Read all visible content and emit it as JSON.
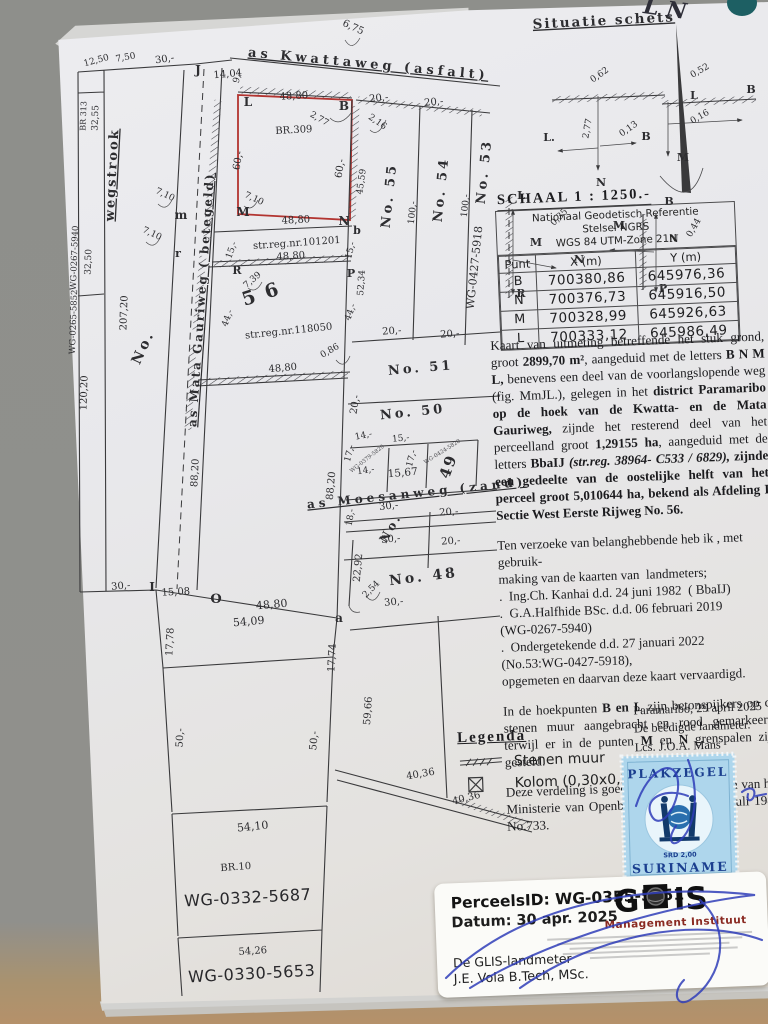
{
  "situatie": {
    "title": "Situatie schets"
  },
  "schaal": "SCHAAL 1 : 1250.-",
  "table": {
    "title_lines": [
      "Nationaal Geodetisch Referentie",
      "Stelsel NGRS",
      "WGS 84 UTM-Zone 21N"
    ],
    "headers": [
      "Punt",
      "X (m)",
      "Y (m)"
    ],
    "rows": [
      [
        "B",
        "700380,86",
        "645976,36"
      ],
      [
        "N",
        "700376,73",
        "645916,50"
      ],
      [
        "M",
        "700328,99",
        "645926,63"
      ],
      [
        "L",
        "700333,12",
        "645986,49"
      ]
    ]
  },
  "paragraphs": [
    {
      "segments": [
        {
          "t": "Kaart van uitmeting betreffende het stuk grond, groot "
        },
        {
          "t": "2899,70 m²",
          "c": "b"
        },
        {
          "t": ", aangeduid met de letters "
        },
        {
          "t": "B N M L,",
          "c": "b"
        },
        {
          "t": " benevens een deel van de voorlangslopende weg (fig. MmJL.), gelegen in het "
        },
        {
          "t": "district Paramaribo op de hoek van de Kwatta- en de Mata Gauriweg,",
          "c": "b"
        },
        {
          "t": " zijnde het resterend deel van het perceelland groot "
        },
        {
          "t": "1,29155 ha",
          "c": "b"
        },
        {
          "t": ", aangeduid met de letters "
        },
        {
          "t": "BbaIJ ",
          "c": "b"
        },
        {
          "t": "(str.reg. 38964- C533 / 6829),",
          "c": "bi"
        },
        {
          "t": " "
        },
        {
          "t": "zijnde een gedeelte van de oostelijke helft van het perceel groot 5,010644 ha, bekend als Afdeling I Sectie West Eerste Rijweg No. 56.",
          "c": "b"
        }
      ]
    },
    {
      "cls": "lines",
      "segments": [
        {
          "t": "Ten verzoeke van belanghebbende heb ik , met gebruik-\nmaking van de kaarten van  landmeters;\n.  Ing.Ch. Kanhai d.d. 24 juni 1982  ( BbaIJ)\n.  G.A.Halfhide BSc. d.d. 06 februari 2019\n(WG-0267-5940)\n.  Ondergetekende d.d. 27 januari 2022\n(No.53:WG-0427-5918),\nopgemeten en daarvan deze kaart vervaardigd."
        }
      ]
    },
    {
      "segments": [
        {
          "t": "In de hoekpunten "
        },
        {
          "t": "B en L",
          "c": "b"
        },
        {
          "t": "  zijn betonspijkers op de stenen muur aangebracht en rood gemarkeerd, terwijl er in de punten "
        },
        {
          "t": "M",
          "c": "b"
        },
        {
          "t": " en "
        },
        {
          "t": "N",
          "c": "b"
        },
        {
          "t": " grenspalen zijn gesteld."
        }
      ]
    },
    {
      "segments": [
        {
          "t": "Deze verdeling is goedgekeurd bij schrijven van het Ministerie van Openbare Werken d.d. 09 juli 1984 No.733."
        }
      ]
    }
  ],
  "signoff": {
    "place_date": "Paramaribo, 29 april 2025",
    "role": "De beëdigde landmeter.",
    "name": "Lcs. J.O.A. Mans"
  },
  "legend": {
    "title": "Legenda",
    "items": [
      {
        "icon": "stenen-muur-symbol",
        "label": "Stenen muur"
      },
      {
        "icon": "kolom-symbol",
        "label": "Kolom (0,30x0,30)"
      }
    ]
  },
  "stamp": {
    "top": "PLAKZEGEL",
    "value": "SRD 2,00",
    "country": "SURINAME"
  },
  "sticker": {
    "perceel": "PerceelsID: WG-0355-5951",
    "datum": "Datum: 30 apr. 2025",
    "landmeter_label": "De GLIS-landmeter",
    "landmeter_name": "J.E. Vola B.Tech, MSc.",
    "logo": "GLIS",
    "logo_sub": "Management Instituut"
  },
  "map": {
    "labels": [
      {
        "t": "12,50",
        "x": 97,
        "y": 63,
        "r": -15,
        "s": 9
      },
      {
        "t": "7,50",
        "x": 126,
        "y": 60,
        "r": -10,
        "s": 9
      },
      {
        "t": "30,-",
        "x": 165,
        "y": 62,
        "r": -8,
        "s": 10
      },
      {
        "t": "J",
        "x": 198,
        "y": 74,
        "s": 12,
        "c": "b"
      },
      {
        "t": "14,04",
        "x": 228,
        "y": 77,
        "r": -5,
        "s": 10
      },
      {
        "t": "9,-",
        "x": 240,
        "y": 78,
        "r": -75,
        "s": 9
      },
      {
        "t": "6,75",
        "x": 352,
        "y": 30,
        "r": 25,
        "s": 10
      },
      {
        "t": "as Kwattaweg (asfalt)",
        "x": 368,
        "y": 68,
        "r": 5.5,
        "s": 13,
        "c": "street"
      },
      {
        "t": "BR 313",
        "x": 86,
        "y": 116,
        "r": -88,
        "s": 8
      },
      {
        "t": "32,55",
        "x": 98,
        "y": 118,
        "r": -88,
        "s": 9
      },
      {
        "t": "wegstrook",
        "x": 116,
        "y": 175,
        "r": -87,
        "s": 13,
        "c": "streetv"
      },
      {
        "t": "WG-0267-5940",
        "x": 77,
        "y": 258,
        "r": -88,
        "s": 8.5
      },
      {
        "t": "32,50",
        "x": 91,
        "y": 262,
        "r": -88,
        "s": 9
      },
      {
        "t": "WG-0265-5852",
        "x": 76,
        "y": 322,
        "r": -88,
        "s": 8.5
      },
      {
        "t": "120,20",
        "x": 87,
        "y": 393,
        "r": -88,
        "s": 10
      },
      {
        "t": "207,20",
        "x": 127,
        "y": 313,
        "r": -88,
        "s": 10
      },
      {
        "t": "No.",
        "x": 147,
        "y": 349,
        "r": -65,
        "s": 14,
        "c": "spread"
      },
      {
        "t": "as Mata Gauriweg ( betegeld)",
        "x": 205,
        "y": 300,
        "r": -86,
        "s": 12,
        "c": "streetv"
      },
      {
        "t": "7,10",
        "x": 164,
        "y": 197,
        "r": 25,
        "s": 9
      },
      {
        "t": "m",
        "x": 181,
        "y": 219,
        "s": 12,
        "c": "b"
      },
      {
        "t": "7,10",
        "x": 151,
        "y": 236,
        "r": 25,
        "s": 9
      },
      {
        "t": "r",
        "x": 178,
        "y": 257,
        "s": 11,
        "c": "b"
      },
      {
        "t": "L",
        "x": 248,
        "y": 106,
        "s": 12,
        "c": "b"
      },
      {
        "t": "48,80",
        "x": 294,
        "y": 99,
        "r": -3,
        "s": 10
      },
      {
        "t": "B",
        "x": 344,
        "y": 110,
        "s": 12,
        "c": "b"
      },
      {
        "t": "2,77",
        "x": 318,
        "y": 121,
        "r": 30,
        "s": 9
      },
      {
        "t": "BR.309",
        "x": 294,
        "y": 133,
        "r": -3,
        "s": 10
      },
      {
        "t": "60,-",
        "x": 241,
        "y": 161,
        "r": -80,
        "s": 10
      },
      {
        "t": "60,-",
        "x": 343,
        "y": 169,
        "r": -80,
        "s": 10
      },
      {
        "t": "7,10",
        "x": 253,
        "y": 201,
        "r": 25,
        "s": 9
      },
      {
        "t": "M",
        "x": 243,
        "y": 216,
        "s": 12,
        "c": "b"
      },
      {
        "t": "48,80",
        "x": 296,
        "y": 223,
        "r": -3,
        "s": 10
      },
      {
        "t": "N",
        "x": 344,
        "y": 225,
        "s": 12,
        "c": "b"
      },
      {
        "t": "20,-",
        "x": 379,
        "y": 101,
        "r": -5,
        "s": 10
      },
      {
        "t": "2,16",
        "x": 376,
        "y": 124,
        "r": 35,
        "s": 9
      },
      {
        "t": "45,59",
        "x": 364,
        "y": 182,
        "r": -82,
        "s": 9
      },
      {
        "t": "b",
        "x": 357,
        "y": 234,
        "s": 11,
        "c": "b"
      },
      {
        "t": "20,-",
        "x": 434,
        "y": 105,
        "r": -5,
        "s": 10
      },
      {
        "t": "No. 55",
        "x": 393,
        "y": 196,
        "r": -84,
        "s": 13,
        "c": "spread"
      },
      {
        "t": "100,-",
        "x": 415,
        "y": 213,
        "r": -84,
        "s": 9
      },
      {
        "t": "No. 54",
        "x": 445,
        "y": 190,
        "r": -84,
        "s": 13,
        "c": "spread"
      },
      {
        "t": "100,-",
        "x": 468,
        "y": 206,
        "r": -84,
        "s": 9
      },
      {
        "t": "WG-0427-5918",
        "x": 478,
        "y": 268,
        "r": -84,
        "s": 11
      },
      {
        "t": "No. 53",
        "x": 488,
        "y": 172,
        "r": -84,
        "s": 13,
        "c": "spread"
      },
      {
        "t": "15,-",
        "x": 234,
        "y": 251,
        "r": -70,
        "s": 9
      },
      {
        "t": "str.reg.nr.101201",
        "x": 297,
        "y": 246,
        "r": -4,
        "s": 10
      },
      {
        "t": "48,80",
        "x": 291,
        "y": 259,
        "r": -4,
        "s": 10
      },
      {
        "t": "15,-",
        "x": 353,
        "y": 251,
        "r": -75,
        "s": 9
      },
      {
        "t": "52,34",
        "x": 364,
        "y": 283,
        "r": -86,
        "s": 9
      },
      {
        "t": "R",
        "x": 237,
        "y": 274,
        "s": 11,
        "c": "b"
      },
      {
        "t": "7,39",
        "x": 254,
        "y": 282,
        "r": -40,
        "s": 9
      },
      {
        "t": "5 6",
        "x": 263,
        "y": 300,
        "r": -18,
        "s": 19,
        "c": "bigb"
      },
      {
        "t": "P",
        "x": 351,
        "y": 277,
        "s": 11,
        "c": "b"
      },
      {
        "t": "44,-",
        "x": 230,
        "y": 319,
        "r": -70,
        "s": 9
      },
      {
        "t": "44,-",
        "x": 353,
        "y": 313,
        "r": -70,
        "s": 9
      },
      {
        "t": "str.reg.nr.118050",
        "x": 289,
        "y": 334,
        "r": -6,
        "s": 10
      },
      {
        "t": "0,86",
        "x": 331,
        "y": 353,
        "r": -30,
        "s": 9
      },
      {
        "t": "48,80",
        "x": 283,
        "y": 371,
        "r": -5,
        "s": 10
      },
      {
        "t": "20,-",
        "x": 392,
        "y": 334,
        "r": -4,
        "s": 10
      },
      {
        "t": "20,-",
        "x": 450,
        "y": 337,
        "r": -4,
        "s": 10
      },
      {
        "t": "No. 51",
        "x": 421,
        "y": 372,
        "r": -5,
        "s": 13,
        "c": "spread"
      },
      {
        "t": "20,-",
        "x": 358,
        "y": 405,
        "r": -80,
        "s": 10
      },
      {
        "t": "No. 50",
        "x": 413,
        "y": 416,
        "r": -6,
        "s": 13,
        "c": "spread"
      },
      {
        "t": "14,-",
        "x": 364,
        "y": 438,
        "r": -12,
        "s": 9
      },
      {
        "t": "17,-",
        "x": 352,
        "y": 454,
        "r": -75,
        "s": 9
      },
      {
        "t": "WG-0379-5829",
        "x": 368,
        "y": 460,
        "r": -38,
        "s": 5.5,
        "c": "tiny"
      },
      {
        "t": "14,-",
        "x": 366,
        "y": 473,
        "r": -8,
        "s": 9
      },
      {
        "t": "15,-",
        "x": 401,
        "y": 441,
        "r": -6,
        "s": 9
      },
      {
        "t": "17,-",
        "x": 414,
        "y": 459,
        "r": -75,
        "s": 9
      },
      {
        "t": "15,67",
        "x": 403,
        "y": 476,
        "r": -5,
        "s": 10.5
      },
      {
        "t": "WG-0424-5820",
        "x": 443,
        "y": 453,
        "r": -32,
        "s": 5.5,
        "c": "tiny"
      },
      {
        "t": "49",
        "x": 453,
        "y": 468,
        "r": -70,
        "s": 15,
        "c": "bigb"
      },
      {
        "t": "as Moesanweg (zand)",
        "x": 417,
        "y": 497,
        "r": -6,
        "s": 12,
        "c": "street"
      },
      {
        "t": "18,-",
        "x": 353,
        "y": 518,
        "r": -80,
        "s": 9
      },
      {
        "t": "30,-",
        "x": 389,
        "y": 509,
        "r": -6,
        "s": 10
      },
      {
        "t": "No.",
        "x": 394,
        "y": 530,
        "r": -60,
        "s": 12,
        "c": "spread"
      },
      {
        "t": "20,-",
        "x": 449,
        "y": 515,
        "r": -4,
        "s": 10
      },
      {
        "t": "30,-",
        "x": 391,
        "y": 542,
        "r": -5,
        "s": 10
      },
      {
        "t": "20,-",
        "x": 451,
        "y": 544,
        "r": -4,
        "s": 10
      },
      {
        "t": "88,20",
        "x": 198,
        "y": 473,
        "r": -87,
        "s": 10
      },
      {
        "t": "88,20",
        "x": 334,
        "y": 486,
        "r": -85,
        "s": 10
      },
      {
        "t": "22,92",
        "x": 361,
        "y": 568,
        "r": -85,
        "s": 10
      },
      {
        "t": "2,54",
        "x": 373,
        "y": 591,
        "r": -45,
        "s": 9
      },
      {
        "t": "No. 48",
        "x": 424,
        "y": 581,
        "r": -7,
        "s": 14,
        "c": "spread"
      },
      {
        "t": "30,-",
        "x": 394,
        "y": 605,
        "r": -5,
        "s": 10
      },
      {
        "t": "30,-",
        "x": 121,
        "y": 589,
        "r": -5,
        "s": 10
      },
      {
        "t": "I",
        "x": 152,
        "y": 591,
        "s": 12,
        "c": "b"
      },
      {
        "t": "15,08",
        "x": 176,
        "y": 595,
        "r": -3,
        "s": 10
      },
      {
        "t": "O",
        "x": 216,
        "y": 603,
        "s": 13,
        "c": "b"
      },
      {
        "t": "48,80",
        "x": 272,
        "y": 608,
        "r": -5,
        "s": 11
      },
      {
        "t": "54,09",
        "x": 249,
        "y": 625,
        "r": -5,
        "s": 11
      },
      {
        "t": "a",
        "x": 339,
        "y": 622,
        "s": 12,
        "c": "b"
      },
      {
        "t": "17,78",
        "x": 173,
        "y": 642,
        "r": -87,
        "s": 10
      },
      {
        "t": "17,74",
        "x": 335,
        "y": 658,
        "r": -87,
        "s": 10
      },
      {
        "t": "50,-",
        "x": 183,
        "y": 738,
        "r": -87,
        "s": 10
      },
      {
        "t": "50,-",
        "x": 317,
        "y": 741,
        "r": -85,
        "s": 10
      },
      {
        "t": "59,66",
        "x": 371,
        "y": 711,
        "r": -86,
        "s": 10
      },
      {
        "t": "40,36",
        "x": 421,
        "y": 777,
        "r": -10,
        "s": 10
      },
      {
        "t": "40,36",
        "x": 467,
        "y": 801,
        "r": -14,
        "s": 10
      },
      {
        "t": "54,10",
        "x": 253,
        "y": 830,
        "r": -6,
        "s": 11
      },
      {
        "t": "BR.10",
        "x": 236,
        "y": 870,
        "r": -4,
        "s": 10
      },
      {
        "t": "WG-0332-5687",
        "x": 248,
        "y": 903,
        "r": -3,
        "s": 16,
        "c": "bigl"
      },
      {
        "t": "54,26",
        "x": 253,
        "y": 954,
        "r": -4,
        "s": 10
      },
      {
        "t": "WG-0330-5653",
        "x": 252,
        "y": 979,
        "r": -3,
        "s": 16,
        "c": "bigl"
      },
      {
        "t": "Situatie schets",
        "x": 604,
        "y": 25,
        "r": -3,
        "s": 13.5,
        "c": "titleu"
      },
      {
        "t": "L N",
        "x": 664,
        "y": 16,
        "r": 8,
        "s": 22,
        "c": "script"
      },
      {
        "t": "0,62",
        "x": 601,
        "y": 77,
        "r": -35,
        "s": 9
      },
      {
        "t": "2,77",
        "x": 590,
        "y": 129,
        "r": -80,
        "s": 9
      },
      {
        "t": "L.",
        "x": 549,
        "y": 141,
        "s": 11,
        "c": "b"
      },
      {
        "t": "B",
        "x": 646,
        "y": 140,
        "s": 11,
        "c": "b"
      },
      {
        "t": "0,13",
        "x": 630,
        "y": 131,
        "r": -35,
        "s": 9
      },
      {
        "t": "N",
        "x": 601,
        "y": 186,
        "s": 11,
        "c": "b"
      },
      {
        "t": "0,52",
        "x": 701,
        "y": 73,
        "r": -30,
        "s": 9
      },
      {
        "t": "L",
        "x": 694,
        "y": 99,
        "s": 11,
        "c": "b"
      },
      {
        "t": "B",
        "x": 751,
        "y": 93,
        "s": 11,
        "c": "b"
      },
      {
        "t": "0,16",
        "x": 701,
        "y": 119,
        "r": -30,
        "s": 9
      },
      {
        "t": "M",
        "x": 683,
        "y": 161,
        "s": 11,
        "c": "b"
      },
      {
        "t": "L",
        "x": 521,
        "y": 199,
        "s": 11,
        "c": "b"
      },
      {
        "t": "0,35",
        "x": 561,
        "y": 219,
        "r": -45,
        "s": 9
      },
      {
        "t": "M",
        "x": 536,
        "y": 246,
        "s": 11,
        "c": "b"
      },
      {
        "t": "N",
        "x": 579,
        "y": 263,
        "s": 11,
        "c": "b"
      },
      {
        "t": "R",
        "x": 521,
        "y": 297,
        "s": 11,
        "c": "b"
      },
      {
        "t": "B",
        "x": 669,
        "y": 205,
        "s": 11,
        "c": "b"
      },
      {
        "t": "M",
        "x": 619,
        "y": 229,
        "s": 11,
        "c": "b"
      },
      {
        "t": "0,44",
        "x": 696,
        "y": 229,
        "r": -60,
        "s": 9
      },
      {
        "t": "N",
        "x": 674,
        "y": 242,
        "s": 10,
        "c": "b"
      },
      {
        "t": "P",
        "x": 663,
        "y": 292,
        "s": 11,
        "c": "b"
      }
    ]
  }
}
